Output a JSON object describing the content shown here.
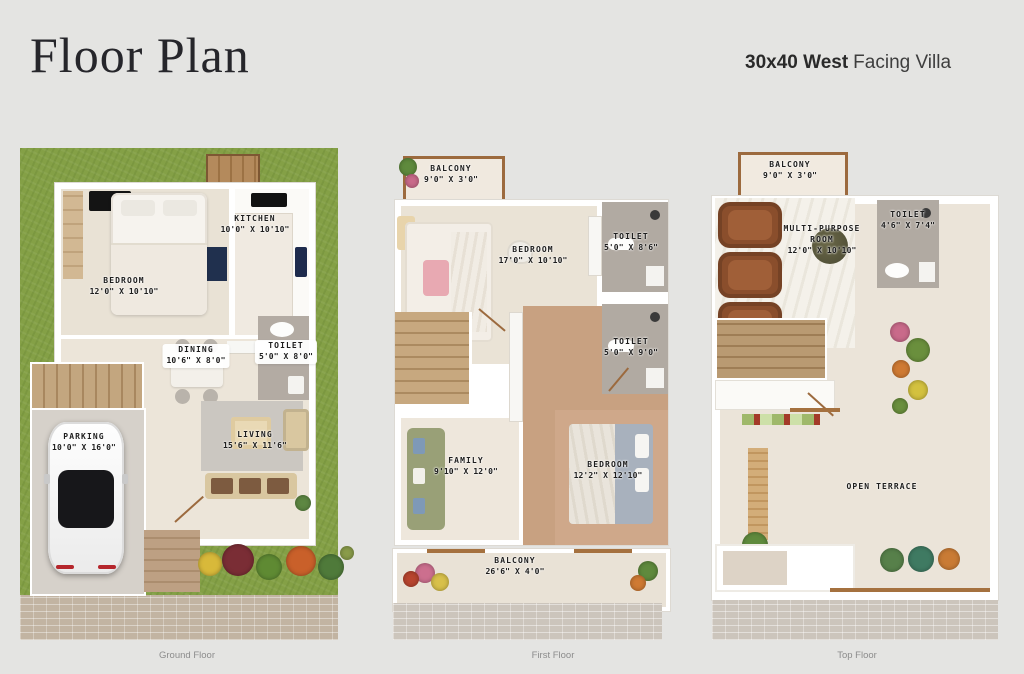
{
  "page": {
    "background": "#e4e4e2"
  },
  "header": {
    "title": "Floor Plan",
    "subtitle_bold": "30x40 West",
    "subtitle_regular": "Facing Villa"
  },
  "palette": {
    "grass_green": "#84a046",
    "floor_cream": "#ebe4d9",
    "wood_brown": "#c9a382",
    "toilet_gray": "#b2aba4",
    "wall_white": "#ffffff",
    "balcony_trim_brown": "#9c6a3e",
    "recliner_brown": "#8a4e2c",
    "pavement_gray": "#ccc5bc",
    "label_ink": "#1d1d1d"
  },
  "floors": [
    {
      "caption": "Ground Floor",
      "rooms": [
        {
          "name": "KITCHEN",
          "dims": "10'0\" X 10'10\""
        },
        {
          "name": "BEDROOM",
          "dims": "12'0\" X 10'10\""
        },
        {
          "name": "DINING",
          "dims": "10'6\" X 8'0\""
        },
        {
          "name": "TOILET",
          "dims": "5'0\" X 8'0\""
        },
        {
          "name": "PARKING",
          "dims": "10'0\" X 16'0\""
        },
        {
          "name": "LIVING",
          "dims": "15'6\" X 11'6\""
        }
      ]
    },
    {
      "caption": "First Floor",
      "rooms": [
        {
          "name": "BALCONY",
          "dims": "9'0\" X 3'0\""
        },
        {
          "name": "BEDROOM",
          "dims": "17'0\" X 10'10\""
        },
        {
          "name": "TOILET",
          "dims": "5'0\" X 8'6\""
        },
        {
          "name": "TOILET",
          "dims": "5'0\" X 9'0\""
        },
        {
          "name": "FAMILY",
          "dims": "9'10\" X 12'0\""
        },
        {
          "name": "BEDROOM",
          "dims": "12'2\" X 12'10\""
        },
        {
          "name": "BALCONY",
          "dims": "26'6\" X 4'0\""
        }
      ]
    },
    {
      "caption": "Top Floor",
      "rooms": [
        {
          "name": "BALCONY",
          "dims": "9'0\" X 3'0\""
        },
        {
          "name": "MULTI-PURPOSE ROOM",
          "dims": "12'0\" X 10'10\""
        },
        {
          "name": "TOILET",
          "dims": "4'6\" X 7'4\""
        },
        {
          "name": "OPEN TERRACE",
          "dims": ""
        }
      ]
    }
  ]
}
